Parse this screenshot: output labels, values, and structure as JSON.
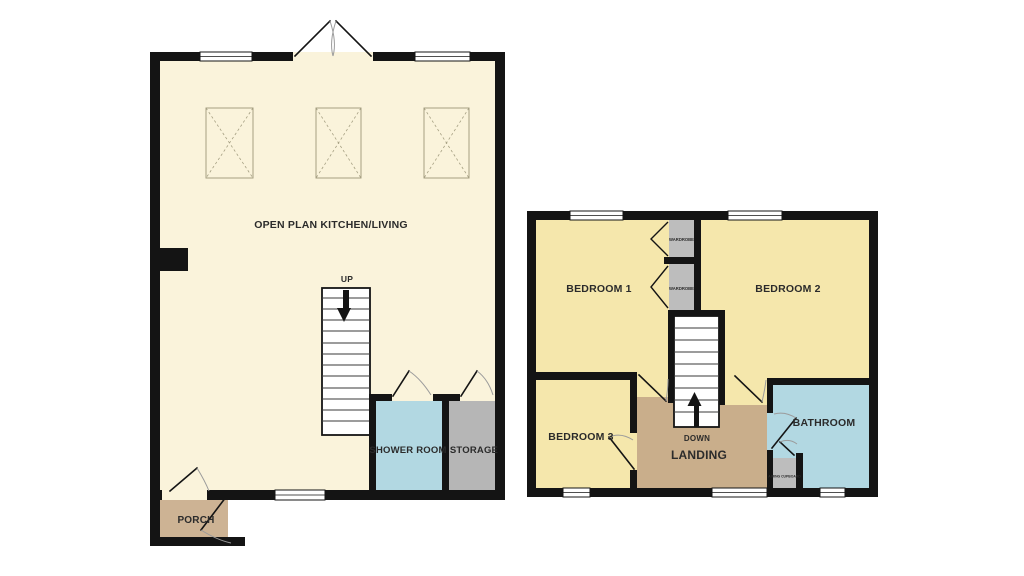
{
  "labels": {
    "ground_floor": {
      "open_plan": "OPEN PLAN KITCHEN/LIVING",
      "up": "UP",
      "shower_room": "SHOWER ROOM",
      "storage": "STORAGE",
      "porch": "PORCH"
    },
    "first_floor": {
      "bedroom1": "BEDROOM 1",
      "bedroom2": "BEDROOM 2",
      "bedroom3": "BEDROOM 3",
      "down": "DOWN",
      "landing": "LANDING",
      "bathroom": "BATHROOM",
      "wardrobe": "WARDROBE",
      "airing_cupboard": "AIRING CUPBOARD"
    }
  },
  "colors": {
    "wall": "#141414",
    "ground_room": "#FAF3DB",
    "bedroom": "#F5E7AC",
    "wet_room": "#B2D8E2",
    "storage": "#B6B6B6",
    "wardrobe": "#BDBDBD",
    "landing": "#C9AE8B",
    "porch": "#CDB394",
    "window": "#FFFFFF",
    "stairs": "#FFFFFF",
    "background": "#FFFFFF"
  }
}
